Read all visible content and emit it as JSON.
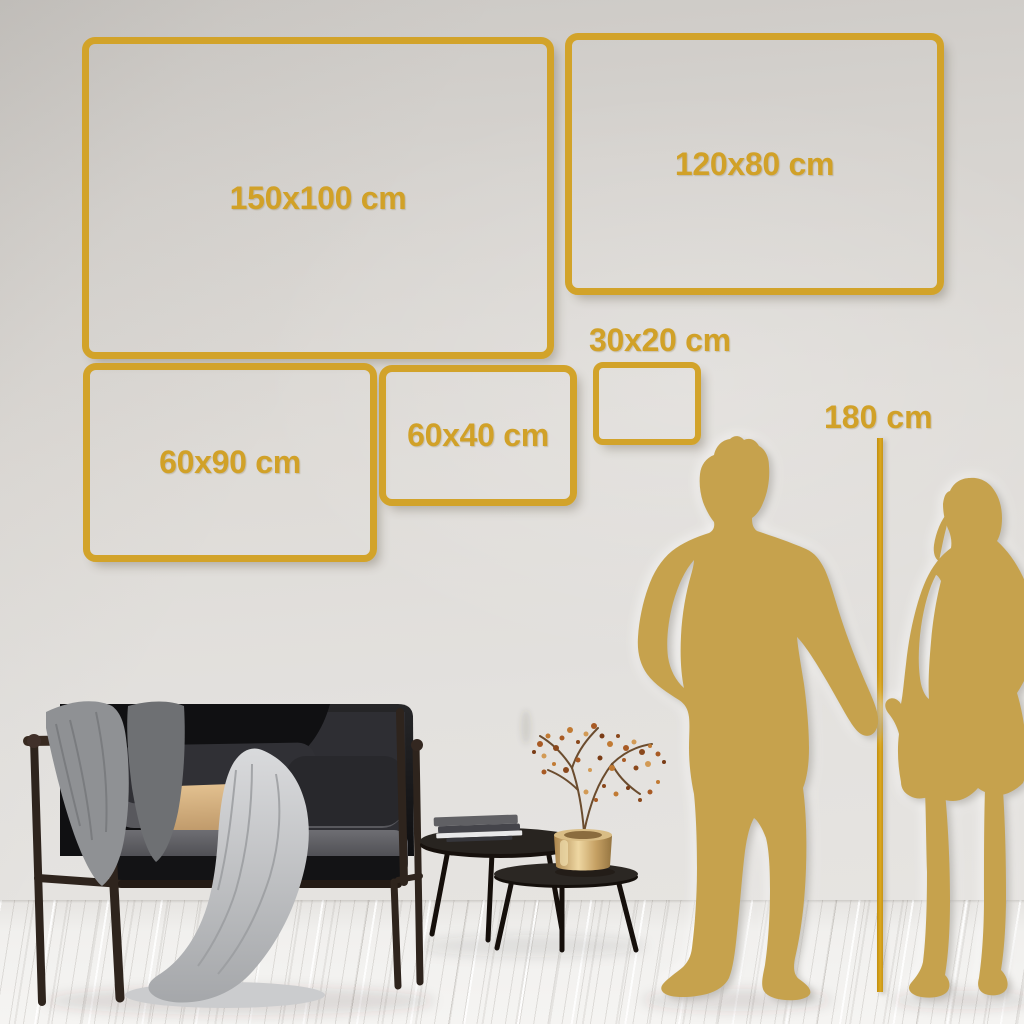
{
  "image_type": "wall art canvas size comparison infographic",
  "colors": {
    "gold_frame": "#d2a32a",
    "gold_text": "#d1a128",
    "ruler_line": "#dba81f",
    "silhouette": "#c6a24d",
    "wall": "#dedbd7",
    "floor": "#f2f1ef"
  },
  "size_options": [
    {
      "label": "150x100 cm",
      "width_cm": 150,
      "height_cm": 100
    },
    {
      "label": "120x80 cm",
      "width_cm": 120,
      "height_cm": 80
    },
    {
      "label": "60x90 cm",
      "width_cm": 60,
      "height_cm": 90
    },
    {
      "label": "60x40 cm",
      "width_cm": 60,
      "height_cm": 40
    },
    {
      "label": "30x20 cm",
      "width_cm": 30,
      "height_cm": 20
    }
  ],
  "height_reference": {
    "label": "180 cm",
    "value_cm": 180
  },
  "scene": {
    "figures": [
      {
        "name": "man-silhouette"
      },
      {
        "name": "woman-silhouette"
      }
    ],
    "furniture": [
      {
        "name": "dark-velvet-sofa-with-blankets"
      },
      {
        "name": "nesting-coffee-tables"
      },
      {
        "name": "books-stack"
      },
      {
        "name": "brass-vase-with-dried-branch"
      }
    ]
  }
}
